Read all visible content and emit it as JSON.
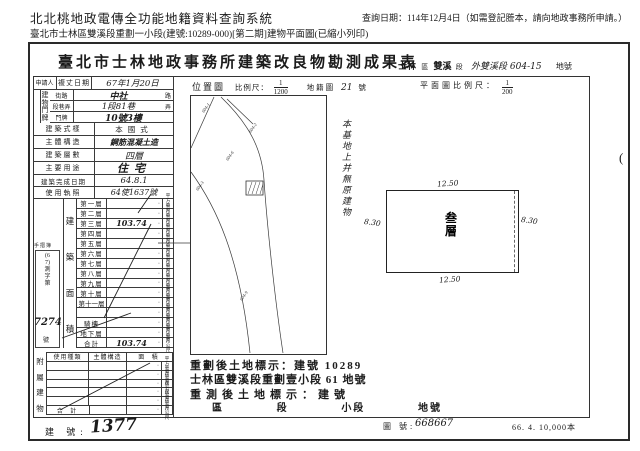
{
  "header": {
    "system_title": "北北桃地政電傳全功能地籍資料查詢系統",
    "query_date": "查詢日期：114年12月4日（如需登記謄本，請向地政事務所申請。）",
    "subtitle": "臺北市士林區雙溪段重劃一小段(建號:10289-000)[第二期]建物平面圖(已縮小列印)"
  },
  "doc": {
    "title": "臺北市士林地政事務所建築改良物勘測成果表",
    "right": {
      "district": "士林",
      "r1": "區",
      "section": "雙溪",
      "r2": "段",
      "hand": "外雙溪段 604-15",
      "r3": "地號"
    },
    "print_note": "66. 4. 10,000本",
    "side_mark": "("
  },
  "form": {
    "applicant": "申請人",
    "survey_date_label": "複丈日期",
    "survey_date_value": "67年1月20日",
    "addr_label": "建物門牌",
    "addr_rows": [
      {
        "label": "街路",
        "value": "中社",
        "suffix": "路"
      },
      {
        "label": "段巷弄",
        "value": "1段81巷",
        "suffix": "弄"
      },
      {
        "label": "門牌",
        "value": "10號3樓",
        "suffix": ""
      }
    ],
    "info_rows": [
      {
        "label": "建築式樣",
        "value": "本國式"
      },
      {
        "label": "主體構造",
        "value": "鋼筋混凝土造"
      },
      {
        "label": "建築層數",
        "value": "四層"
      },
      {
        "label": "主要用途",
        "value": "住宅"
      },
      {
        "label": "建築完成日期",
        "value": "64.8.1"
      },
      {
        "label": "使用執照",
        "value": "64使1637號"
      }
    ],
    "area_label": "建築面積",
    "area_unit": "平方公尺",
    "dot": "·",
    "floors": [
      {
        "name": "第一層",
        "value": ""
      },
      {
        "name": "第二層",
        "value": ""
      },
      {
        "name": "第三層",
        "value": "103.74"
      },
      {
        "name": "第四層",
        "value": ""
      },
      {
        "name": "第五層",
        "value": ""
      },
      {
        "name": "第六層",
        "value": ""
      },
      {
        "name": "第七層",
        "value": ""
      },
      {
        "name": "第八層",
        "value": ""
      },
      {
        "name": "第九層",
        "value": ""
      },
      {
        "name": "第十層",
        "value": ""
      },
      {
        "name": "第十一層",
        "value": ""
      },
      {
        "name": "",
        "value": ""
      },
      {
        "name": "騎樓",
        "value": ""
      },
      {
        "name": "地下層",
        "value": ""
      },
      {
        "name": "合計",
        "value": "103.74"
      }
    ],
    "survey_box": {
      "header": "手摺簿",
      "vertical": "(67)測字第",
      "number": "7274",
      "suffix": "號"
    },
    "attached": {
      "label": "附屬建物",
      "headers": [
        "使用種類",
        "主體構造",
        "面 積"
      ],
      "total_label": "合 計"
    }
  },
  "location": {
    "label": "位置圖",
    "scale_label": "比例尺：",
    "num": "1",
    "den": "1200",
    "cad_label": "地籍圖",
    "cad_no": "21",
    "cad_suffix": "號",
    "parcels": [
      "604-1",
      "604-2",
      "604-6",
      "604-3",
      "604-9"
    ]
  },
  "plan": {
    "scale_label": "平面圖比例尺：",
    "num": "1",
    "den": "200",
    "note": "本基地上并無原建物",
    "dim_top": "12.50",
    "dim_bottom": "12.50",
    "dim_left": "8.30",
    "dim_right": "8.30",
    "stamp": "叁層"
  },
  "bottom": {
    "replot1": "重劃後土地標示：建號 10289",
    "replot2": "士林區雙溪段重劃壹小段 61 地號",
    "resurvey": "重測後土地標示：建號",
    "cols": [
      "區",
      "段",
      "小段",
      "地號"
    ],
    "bno_label": "建 號:",
    "bno_value": "1377",
    "map_no_label": "圖 號:",
    "map_no_value": "668667"
  }
}
